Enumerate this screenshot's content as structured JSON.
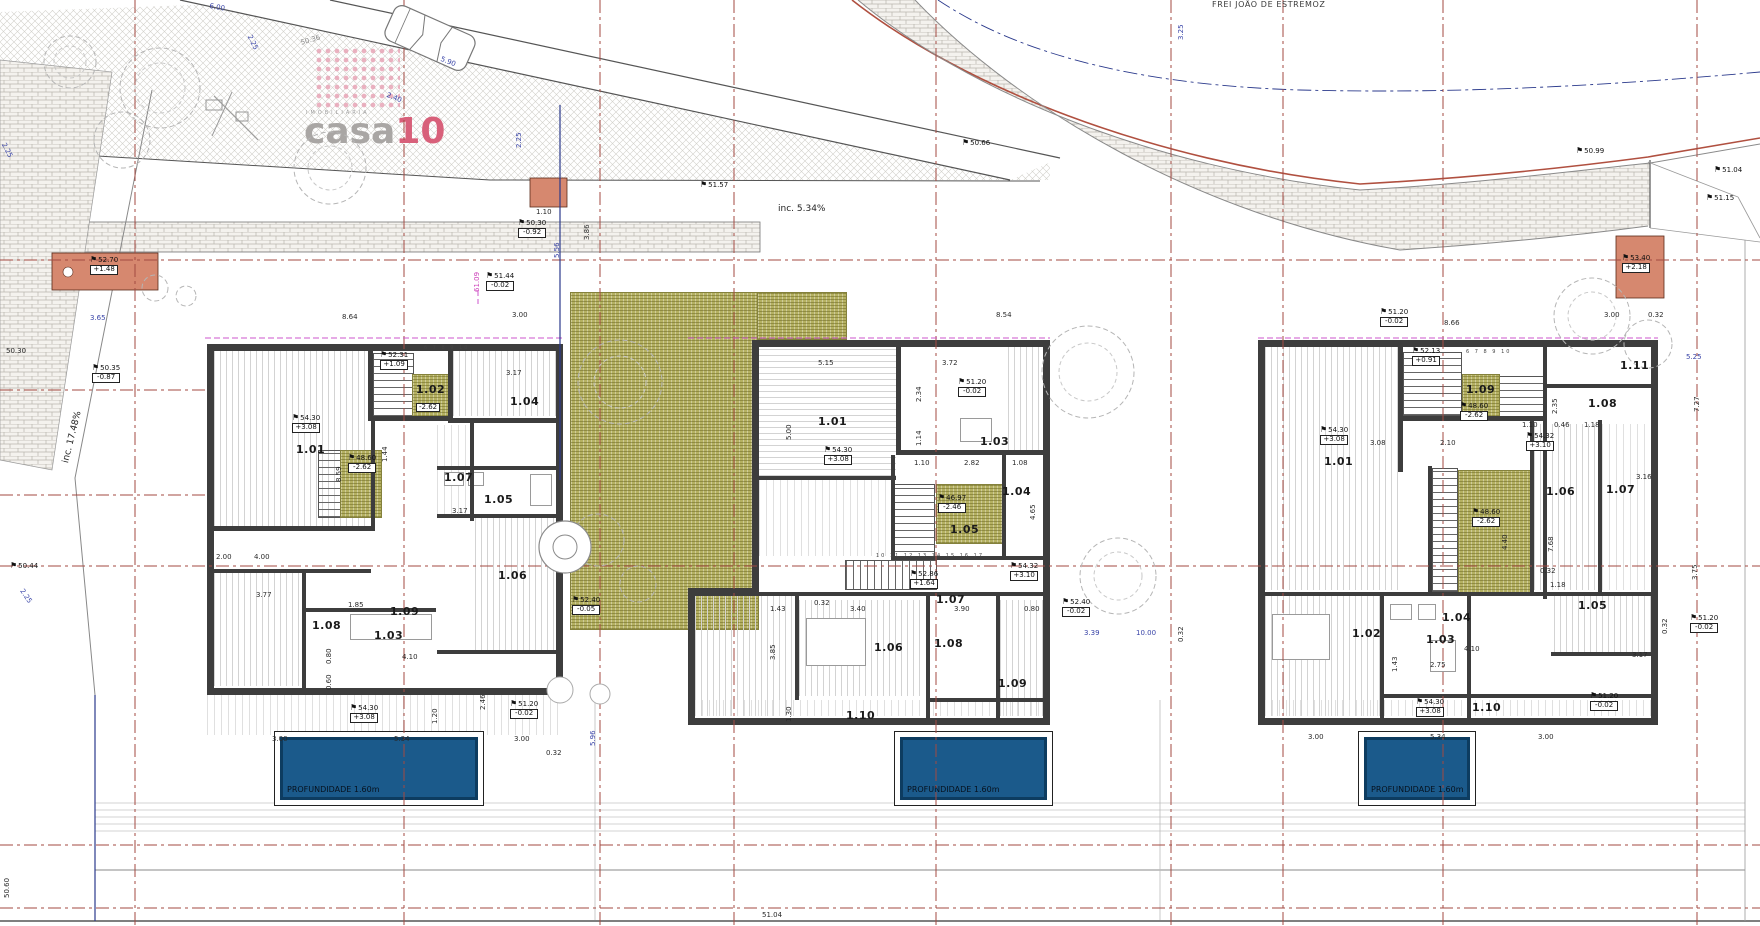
{
  "logo": {
    "brand_gray": "casa",
    "brand_accent": "10",
    "tagline": "IMOBILIARIA",
    "accent_color": "#d8607a"
  },
  "street": {
    "name": "FREI JOÃO DE ESTREMOZ"
  },
  "pool": {
    "depth_label": "PROFUNDIDADE 1.60m",
    "fill_color": "#1b5a8b"
  },
  "colors": {
    "grid_line": "#a34a42",
    "wall": "#3d3d3d",
    "stair_green": "#b5b162",
    "entry_salmon": "#d6886f",
    "property_navy": "#2b3a8c",
    "magenta": "#cc3db8"
  },
  "labels": [
    {
      "t": "6.00",
      "x": 210,
      "y": 3,
      "c": "dim",
      "r": 10
    },
    {
      "t": "2.25",
      "x": 252,
      "y": 34,
      "c": "dim",
      "r": 64
    },
    {
      "t": "50.36",
      "x": 300,
      "y": 40,
      "c": "dimg",
      "r": -16
    },
    {
      "t": "5.90",
      "x": 442,
      "y": 56,
      "c": "dim",
      "r": 22
    },
    {
      "t": "2.40",
      "x": 388,
      "y": 92,
      "c": "dim",
      "r": 22
    },
    {
      "t": "FREI JOÃO DE ESTREMOZ",
      "x": 1212,
      "y": 1,
      "c": "street"
    },
    {
      "t": "3.25",
      "x": 1178,
      "y": 40,
      "c": "dim",
      "r": -90
    },
    {
      "t": "inc. 5.34%",
      "x": 778,
      "y": 205,
      "c": "inc"
    },
    {
      "t": "51.57",
      "x": 700,
      "y": 181,
      "c": "elev"
    },
    {
      "t": "50.66",
      "x": 962,
      "y": 139,
      "c": "elev"
    },
    {
      "t": "50.99",
      "x": 1576,
      "y": 147,
      "c": "elev"
    },
    {
      "t": "51.04",
      "x": 1714,
      "y": 166,
      "c": "elev"
    },
    {
      "t": "51.15",
      "x": 1706,
      "y": 194,
      "c": "elev"
    },
    {
      "t": "53.40",
      "b": "+2.18",
      "x": 1622,
      "y": 254,
      "c": "elev"
    },
    {
      "t": "1.10",
      "x": 536,
      "y": 209,
      "c": "dimk"
    },
    {
      "t": "50.30",
      "b": "-0.92",
      "x": 518,
      "y": 219,
      "c": "elev"
    },
    {
      "t": "51.44",
      "b": "-0.02",
      "x": 486,
      "y": 272,
      "c": "elev"
    },
    {
      "t": "2.25",
      "x": 516,
      "y": 148,
      "c": "dim",
      "r": -90
    },
    {
      "t": "5.56",
      "x": 554,
      "y": 258,
      "c": "dim",
      "r": -90
    },
    {
      "t": "3.86",
      "x": 584,
      "y": 240,
      "c": "dimk",
      "r": -90
    },
    {
      "t": "2.25",
      "x": 6,
      "y": 142,
      "c": "dim",
      "r": 62
    },
    {
      "t": "52.70",
      "b": "+1.48",
      "x": 90,
      "y": 256,
      "c": "elev"
    },
    {
      "t": "3.65",
      "x": 90,
      "y": 315,
      "c": "dim"
    },
    {
      "t": "50.30",
      "x": 6,
      "y": 348,
      "c": "dimk"
    },
    {
      "t": "50.35",
      "b": "-0.87",
      "x": 92,
      "y": 364,
      "c": "elev"
    },
    {
      "t": "inc. 17.48%",
      "x": 62,
      "y": 462,
      "c": "inc",
      "r": -76
    },
    {
      "t": "50.44",
      "x": 10,
      "y": 562,
      "c": "elev"
    },
    {
      "t": "2.25",
      "x": 24,
      "y": 588,
      "c": "dim",
      "r": 56
    },
    {
      "t": "50.60",
      "x": 4,
      "y": 898,
      "c": "dimk",
      "r": -90
    },
    {
      "t": "51.04",
      "x": 762,
      "y": 912,
      "c": "dimk"
    },
    {
      "t": "61.09",
      "x": 474,
      "y": 292,
      "c": "mag",
      "r": -90
    },
    {
      "t": "8.64",
      "x": 342,
      "y": 314,
      "c": "dimk"
    },
    {
      "t": "3.00",
      "x": 512,
      "y": 312,
      "c": "dimk"
    },
    {
      "t": "52.31",
      "b": "+1.09",
      "x": 380,
      "y": 351,
      "c": "elev"
    },
    {
      "t": "6 7 8 9 10",
      "x": 424,
      "y": 346,
      "c": "tiny"
    },
    {
      "t": "1.02",
      "x": 416,
      "y": 384,
      "c": "room"
    },
    {
      "b": "-2.62",
      "x": 416,
      "y": 402,
      "c": "elev"
    },
    {
      "t": "1.04",
      "x": 510,
      "y": 396,
      "c": "room"
    },
    {
      "t": "3.17",
      "x": 506,
      "y": 370,
      "c": "dimk"
    },
    {
      "t": "1.01",
      "x": 296,
      "y": 444,
      "c": "room"
    },
    {
      "t": "54.30",
      "b": "+3.08",
      "x": 292,
      "y": 414,
      "c": "elev"
    },
    {
      "t": "1.44",
      "x": 382,
      "y": 462,
      "c": "dimk",
      "r": -90
    },
    {
      "t": "8.59",
      "x": 336,
      "y": 482,
      "c": "dimk",
      "r": -90
    },
    {
      "t": "1.07",
      "x": 444,
      "y": 472,
      "c": "room"
    },
    {
      "t": "48.60",
      "b": "-2.62",
      "x": 348,
      "y": 454,
      "c": "elev"
    },
    {
      "t": "1.05",
      "x": 484,
      "y": 494,
      "c": "room"
    },
    {
      "t": "3.17",
      "x": 452,
      "y": 508,
      "c": "dimk"
    },
    {
      "t": "1.06",
      "x": 498,
      "y": 570,
      "c": "room"
    },
    {
      "t": "1.08",
      "x": 312,
      "y": 620,
      "c": "room"
    },
    {
      "t": "1.09",
      "x": 390,
      "y": 606,
      "c": "room"
    },
    {
      "t": "1.03",
      "x": 374,
      "y": 630,
      "c": "room"
    },
    {
      "t": "2.00",
      "x": 216,
      "y": 554,
      "c": "dimk"
    },
    {
      "t": "4.00",
      "x": 254,
      "y": 554,
      "c": "dimk"
    },
    {
      "t": "3.77",
      "x": 256,
      "y": 592,
      "c": "dimk"
    },
    {
      "t": "1.85",
      "x": 348,
      "y": 602,
      "c": "dimk"
    },
    {
      "t": "0.80",
      "x": 326,
      "y": 664,
      "c": "dimk",
      "r": -90
    },
    {
      "t": "0.60",
      "x": 326,
      "y": 690,
      "c": "dimk",
      "r": -90
    },
    {
      "t": "4.10",
      "x": 402,
      "y": 654,
      "c": "dimk"
    },
    {
      "t": "54.30",
      "b": "+3.08",
      "x": 350,
      "y": 704,
      "c": "elev"
    },
    {
      "t": "51.20",
      "b": "-0.02",
      "x": 510,
      "y": 700,
      "c": "elev"
    },
    {
      "t": "1.20",
      "x": 432,
      "y": 724,
      "c": "dimk",
      "r": -90
    },
    {
      "t": "2.46",
      "x": 480,
      "y": 710,
      "c": "dimk",
      "r": -90
    },
    {
      "t": "3.00",
      "x": 272,
      "y": 736,
      "c": "dimk"
    },
    {
      "t": "5.34",
      "x": 394,
      "y": 736,
      "c": "dimk"
    },
    {
      "t": "3.00",
      "x": 514,
      "y": 736,
      "c": "dimk"
    },
    {
      "t": "0.32",
      "x": 546,
      "y": 750,
      "c": "dimk"
    },
    {
      "t": "52.40",
      "b": "-0.05",
      "x": 572,
      "y": 596,
      "c": "elev"
    },
    {
      "t": "5.96",
      "x": 590,
      "y": 746,
      "c": "dim",
      "r": -90
    },
    {
      "t": "8.54",
      "x": 996,
      "y": 312,
      "c": "dimk"
    },
    {
      "t": "5.15",
      "x": 818,
      "y": 360,
      "c": "dimk"
    },
    {
      "t": "3.72",
      "x": 942,
      "y": 360,
      "c": "dimk"
    },
    {
      "t": "2.34",
      "x": 916,
      "y": 402,
      "c": "dimk",
      "r": -90
    },
    {
      "t": "51.20",
      "b": "-0.02",
      "x": 958,
      "y": 378,
      "c": "elev"
    },
    {
      "t": "1.01",
      "x": 818,
      "y": 416,
      "c": "room"
    },
    {
      "t": "5.00",
      "x": 786,
      "y": 440,
      "c": "dimk",
      "r": -90
    },
    {
      "t": "54.30",
      "b": "+3.08",
      "x": 824,
      "y": 446,
      "c": "elev"
    },
    {
      "t": "1.14",
      "x": 916,
      "y": 446,
      "c": "dimk",
      "r": -90
    },
    {
      "t": "1.10",
      "x": 914,
      "y": 460,
      "c": "dimk"
    },
    {
      "t": "2.82",
      "x": 964,
      "y": 460,
      "c": "dimk"
    },
    {
      "t": "1.08",
      "x": 1012,
      "y": 460,
      "c": "dimk"
    },
    {
      "t": "1.03",
      "x": 980,
      "y": 436,
      "c": "room"
    },
    {
      "t": "1.04",
      "x": 1002,
      "y": 486,
      "c": "room"
    },
    {
      "t": "46.97",
      "b": "-2.46",
      "x": 938,
      "y": 494,
      "c": "elev"
    },
    {
      "t": "1.05",
      "x": 950,
      "y": 524,
      "c": "room"
    },
    {
      "t": "4.65",
      "x": 1030,
      "y": 520,
      "c": "dimk",
      "r": -90
    },
    {
      "t": "10 11 12 13 14 15 16 17",
      "x": 876,
      "y": 554,
      "c": "tiny"
    },
    {
      "t": "52.86",
      "b": "+1.64",
      "x": 910,
      "y": 570,
      "c": "elev"
    },
    {
      "t": "54.32",
      "b": "+3.10",
      "x": 1010,
      "y": 562,
      "c": "elev"
    },
    {
      "t": "1.07",
      "x": 936,
      "y": 594,
      "c": "room"
    },
    {
      "t": "1.43",
      "x": 770,
      "y": 606,
      "c": "dimk"
    },
    {
      "t": "0.32",
      "x": 814,
      "y": 600,
      "c": "dimk"
    },
    {
      "t": "3.40",
      "x": 850,
      "y": 606,
      "c": "dimk"
    },
    {
      "t": "3.90",
      "x": 954,
      "y": 606,
      "c": "dimk"
    },
    {
      "t": "0.80",
      "x": 1024,
      "y": 606,
      "c": "dimk"
    },
    {
      "t": "3.85",
      "x": 770,
      "y": 660,
      "c": "dimk",
      "r": -90
    },
    {
      "t": "1.06",
      "x": 874,
      "y": 642,
      "c": "room"
    },
    {
      "t": "1.08",
      "x": 934,
      "y": 638,
      "c": "room"
    },
    {
      "t": "1.09",
      "x": 998,
      "y": 678,
      "c": "room"
    },
    {
      "t": "1.30",
      "x": 786,
      "y": 722,
      "c": "dimk",
      "r": -90
    },
    {
      "t": "1.10",
      "x": 846,
      "y": 710,
      "c": "room"
    },
    {
      "t": "52.40",
      "b": "-0.02",
      "x": 1062,
      "y": 598,
      "c": "elev"
    },
    {
      "t": "3.39",
      "x": 1084,
      "y": 630,
      "c": "dim"
    },
    {
      "t": "10.00",
      "x": 1136,
      "y": 630,
      "c": "dim"
    },
    {
      "t": "0.32",
      "x": 1178,
      "y": 642,
      "c": "dimk",
      "r": -90
    },
    {
      "t": "51.20",
      "b": "-0.02",
      "x": 1380,
      "y": 308,
      "c": "elev"
    },
    {
      "t": "8.66",
      "x": 1444,
      "y": 320,
      "c": "dimk"
    },
    {
      "t": "3.00",
      "x": 1604,
      "y": 312,
      "c": "dimk"
    },
    {
      "t": "0.32",
      "x": 1648,
      "y": 312,
      "c": "dimk"
    },
    {
      "t": "1.11",
      "x": 1620,
      "y": 360,
      "c": "room"
    },
    {
      "t": "52.13",
      "b": "+0.91",
      "x": 1412,
      "y": 347,
      "c": "elev"
    },
    {
      "t": "6 7 8 9 10",
      "x": 1466,
      "y": 350,
      "c": "tiny"
    },
    {
      "t": "1.09",
      "x": 1466,
      "y": 384,
      "c": "room"
    },
    {
      "t": "48.60",
      "b": "-2.62",
      "x": 1460,
      "y": 402,
      "c": "elev"
    },
    {
      "t": "1.10",
      "x": 1522,
      "y": 422,
      "c": "dimk"
    },
    {
      "t": "0.46",
      "x": 1554,
      "y": 422,
      "c": "dimk"
    },
    {
      "t": "1.18",
      "x": 1584,
      "y": 422,
      "c": "dimk"
    },
    {
      "t": "2.35",
      "x": 1552,
      "y": 414,
      "c": "dimk",
      "r": -90
    },
    {
      "t": "54.32",
      "b": "+3.10",
      "x": 1526,
      "y": 432,
      "c": "elev"
    },
    {
      "t": "1.08",
      "x": 1588,
      "y": 398,
      "c": "room"
    },
    {
      "t": "3.08",
      "x": 1370,
      "y": 440,
      "c": "dimk"
    },
    {
      "t": "2.10",
      "x": 1440,
      "y": 440,
      "c": "dimk"
    },
    {
      "t": "1.01",
      "x": 1324,
      "y": 456,
      "c": "room"
    },
    {
      "t": "54.30",
      "b": "+3.08",
      "x": 1320,
      "y": 426,
      "c": "elev"
    },
    {
      "t": "1.06",
      "x": 1546,
      "y": 486,
      "c": "room"
    },
    {
      "t": "48.60",
      "b": "-2.62",
      "x": 1472,
      "y": 508,
      "c": "elev"
    },
    {
      "t": "1.07",
      "x": 1606,
      "y": 484,
      "c": "room"
    },
    {
      "t": "3.16",
      "x": 1636,
      "y": 474,
      "c": "dimk"
    },
    {
      "t": "4.40",
      "x": 1502,
      "y": 550,
      "c": "dimk",
      "r": -90
    },
    {
      "t": "7.68",
      "x": 1548,
      "y": 552,
      "c": "dimk",
      "r": -90
    },
    {
      "t": "0.32",
      "x": 1540,
      "y": 568,
      "c": "dimk"
    },
    {
      "t": "1.18",
      "x": 1550,
      "y": 582,
      "c": "dimk"
    },
    {
      "t": "1.02",
      "x": 1352,
      "y": 628,
      "c": "room"
    },
    {
      "t": "1.03",
      "x": 1426,
      "y": 634,
      "c": "room"
    },
    {
      "t": "1.04",
      "x": 1442,
      "y": 612,
      "c": "room"
    },
    {
      "t": "1.05",
      "x": 1578,
      "y": 600,
      "c": "room"
    },
    {
      "t": "4.10",
      "x": 1464,
      "y": 646,
      "c": "dimk"
    },
    {
      "t": "3.17",
      "x": 1632,
      "y": 652,
      "c": "dimk"
    },
    {
      "t": "1.43",
      "x": 1392,
      "y": 672,
      "c": "dimk",
      "r": -90
    },
    {
      "t": "2.75",
      "x": 1430,
      "y": 662,
      "c": "dimk"
    },
    {
      "t": "1.10",
      "x": 1472,
      "y": 702,
      "c": "room"
    },
    {
      "t": "54.30",
      "b": "+3.08",
      "x": 1416,
      "y": 698,
      "c": "elev"
    },
    {
      "t": "51.20",
      "b": "-0.02",
      "x": 1590,
      "y": 692,
      "c": "elev"
    },
    {
      "t": "3.00",
      "x": 1308,
      "y": 734,
      "c": "dimk"
    },
    {
      "t": "5.34",
      "x": 1430,
      "y": 734,
      "c": "dimk"
    },
    {
      "t": "3.00",
      "x": 1538,
      "y": 734,
      "c": "dimk"
    },
    {
      "t": "5.25",
      "x": 1686,
      "y": 354,
      "c": "dim"
    },
    {
      "t": "7.27",
      "x": 1694,
      "y": 412,
      "c": "dimk",
      "r": -90
    },
    {
      "t": "3.75",
      "x": 1692,
      "y": 580,
      "c": "dimk",
      "r": -90
    },
    {
      "t": "0.32",
      "x": 1662,
      "y": 634,
      "c": "dimk",
      "r": -90
    },
    {
      "t": "51.20",
      "b": "-0.02",
      "x": 1690,
      "y": 614,
      "c": "elev"
    }
  ]
}
